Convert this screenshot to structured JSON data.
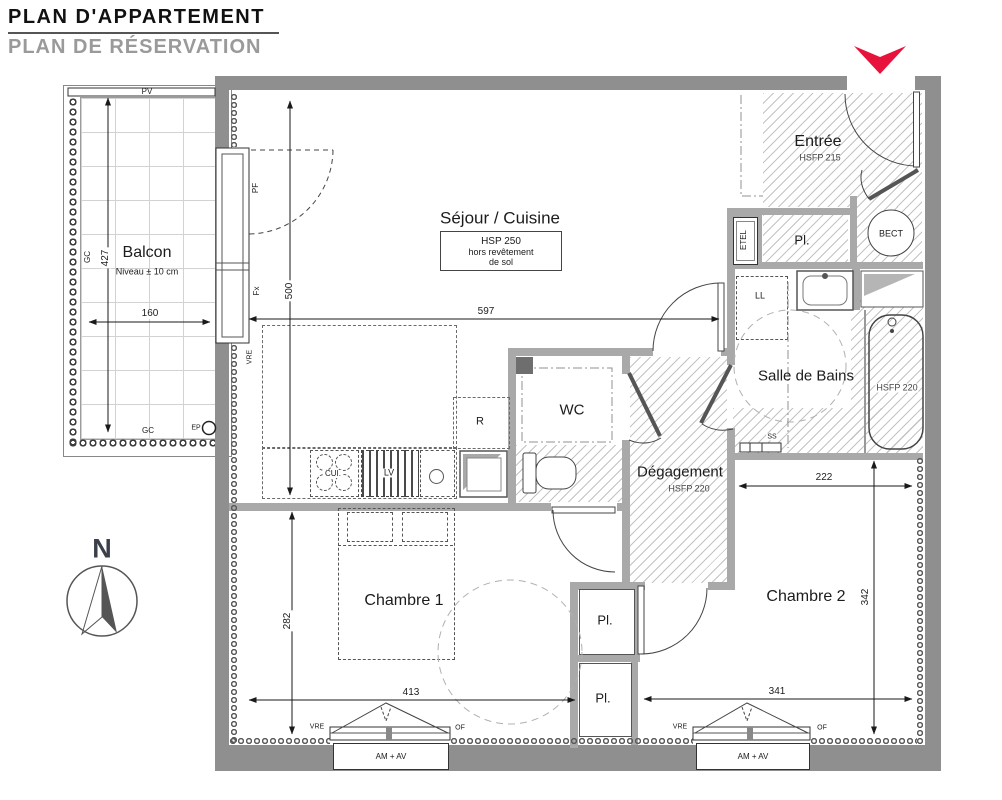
{
  "header": {
    "title": "PLAN D'APPARTEMENT",
    "subtitle": "PLAN DE RÉSERVATION"
  },
  "compass": {
    "north": "N"
  },
  "balcony": {
    "name": "Balcon",
    "level_note": "Niveau ± 10 cm",
    "dim_height": "427",
    "dim_width": "160",
    "pv": "PV",
    "gc_left": "GC",
    "gc_bottom": "GC",
    "ep": "EP"
  },
  "living": {
    "name": "Séjour / Cuisine",
    "box_l1": "HSP 250",
    "box_l2": "hors revêtement",
    "box_l3": "de sol",
    "dim_width": "597",
    "dim_height": "500",
    "pf": "PF",
    "fx": "Fx",
    "vre": "VRE"
  },
  "kitchen": {
    "cui": "CUI.",
    "lv": "LV",
    "r": "R"
  },
  "wc": {
    "name": "WC"
  },
  "hall": {
    "name": "Dégagement",
    "hsfp": "HSFP 220"
  },
  "entry": {
    "name": "Entrée",
    "hsfp": "HSFP 215",
    "etel": "ETEL",
    "pl": "Pl.",
    "bect": "BECT"
  },
  "bath": {
    "name": "Salle de Bains",
    "hsfp": "HSFP 220",
    "ll": "LL",
    "ss": "SS"
  },
  "bedroom1": {
    "name": "Chambre 1",
    "dim_height": "282",
    "dim_width": "413",
    "vre": "VRE",
    "of": "OF",
    "am_av": "AM + AV"
  },
  "bedroom2": {
    "name": "Chambre 2",
    "dim_top": "222",
    "dim_height": "342",
    "dim_width": "341",
    "pl_upper": "Pl.",
    "pl_lower": "Pl.",
    "vre": "VRE",
    "of": "OF",
    "am_av": "AM + AV"
  },
  "colors": {
    "wall_exterior": "#8f8f8f",
    "wall_interior": "#a9a9a9",
    "entrance_arrow": "#e8133c",
    "subtitle_gray": "#9a9a9a"
  }
}
